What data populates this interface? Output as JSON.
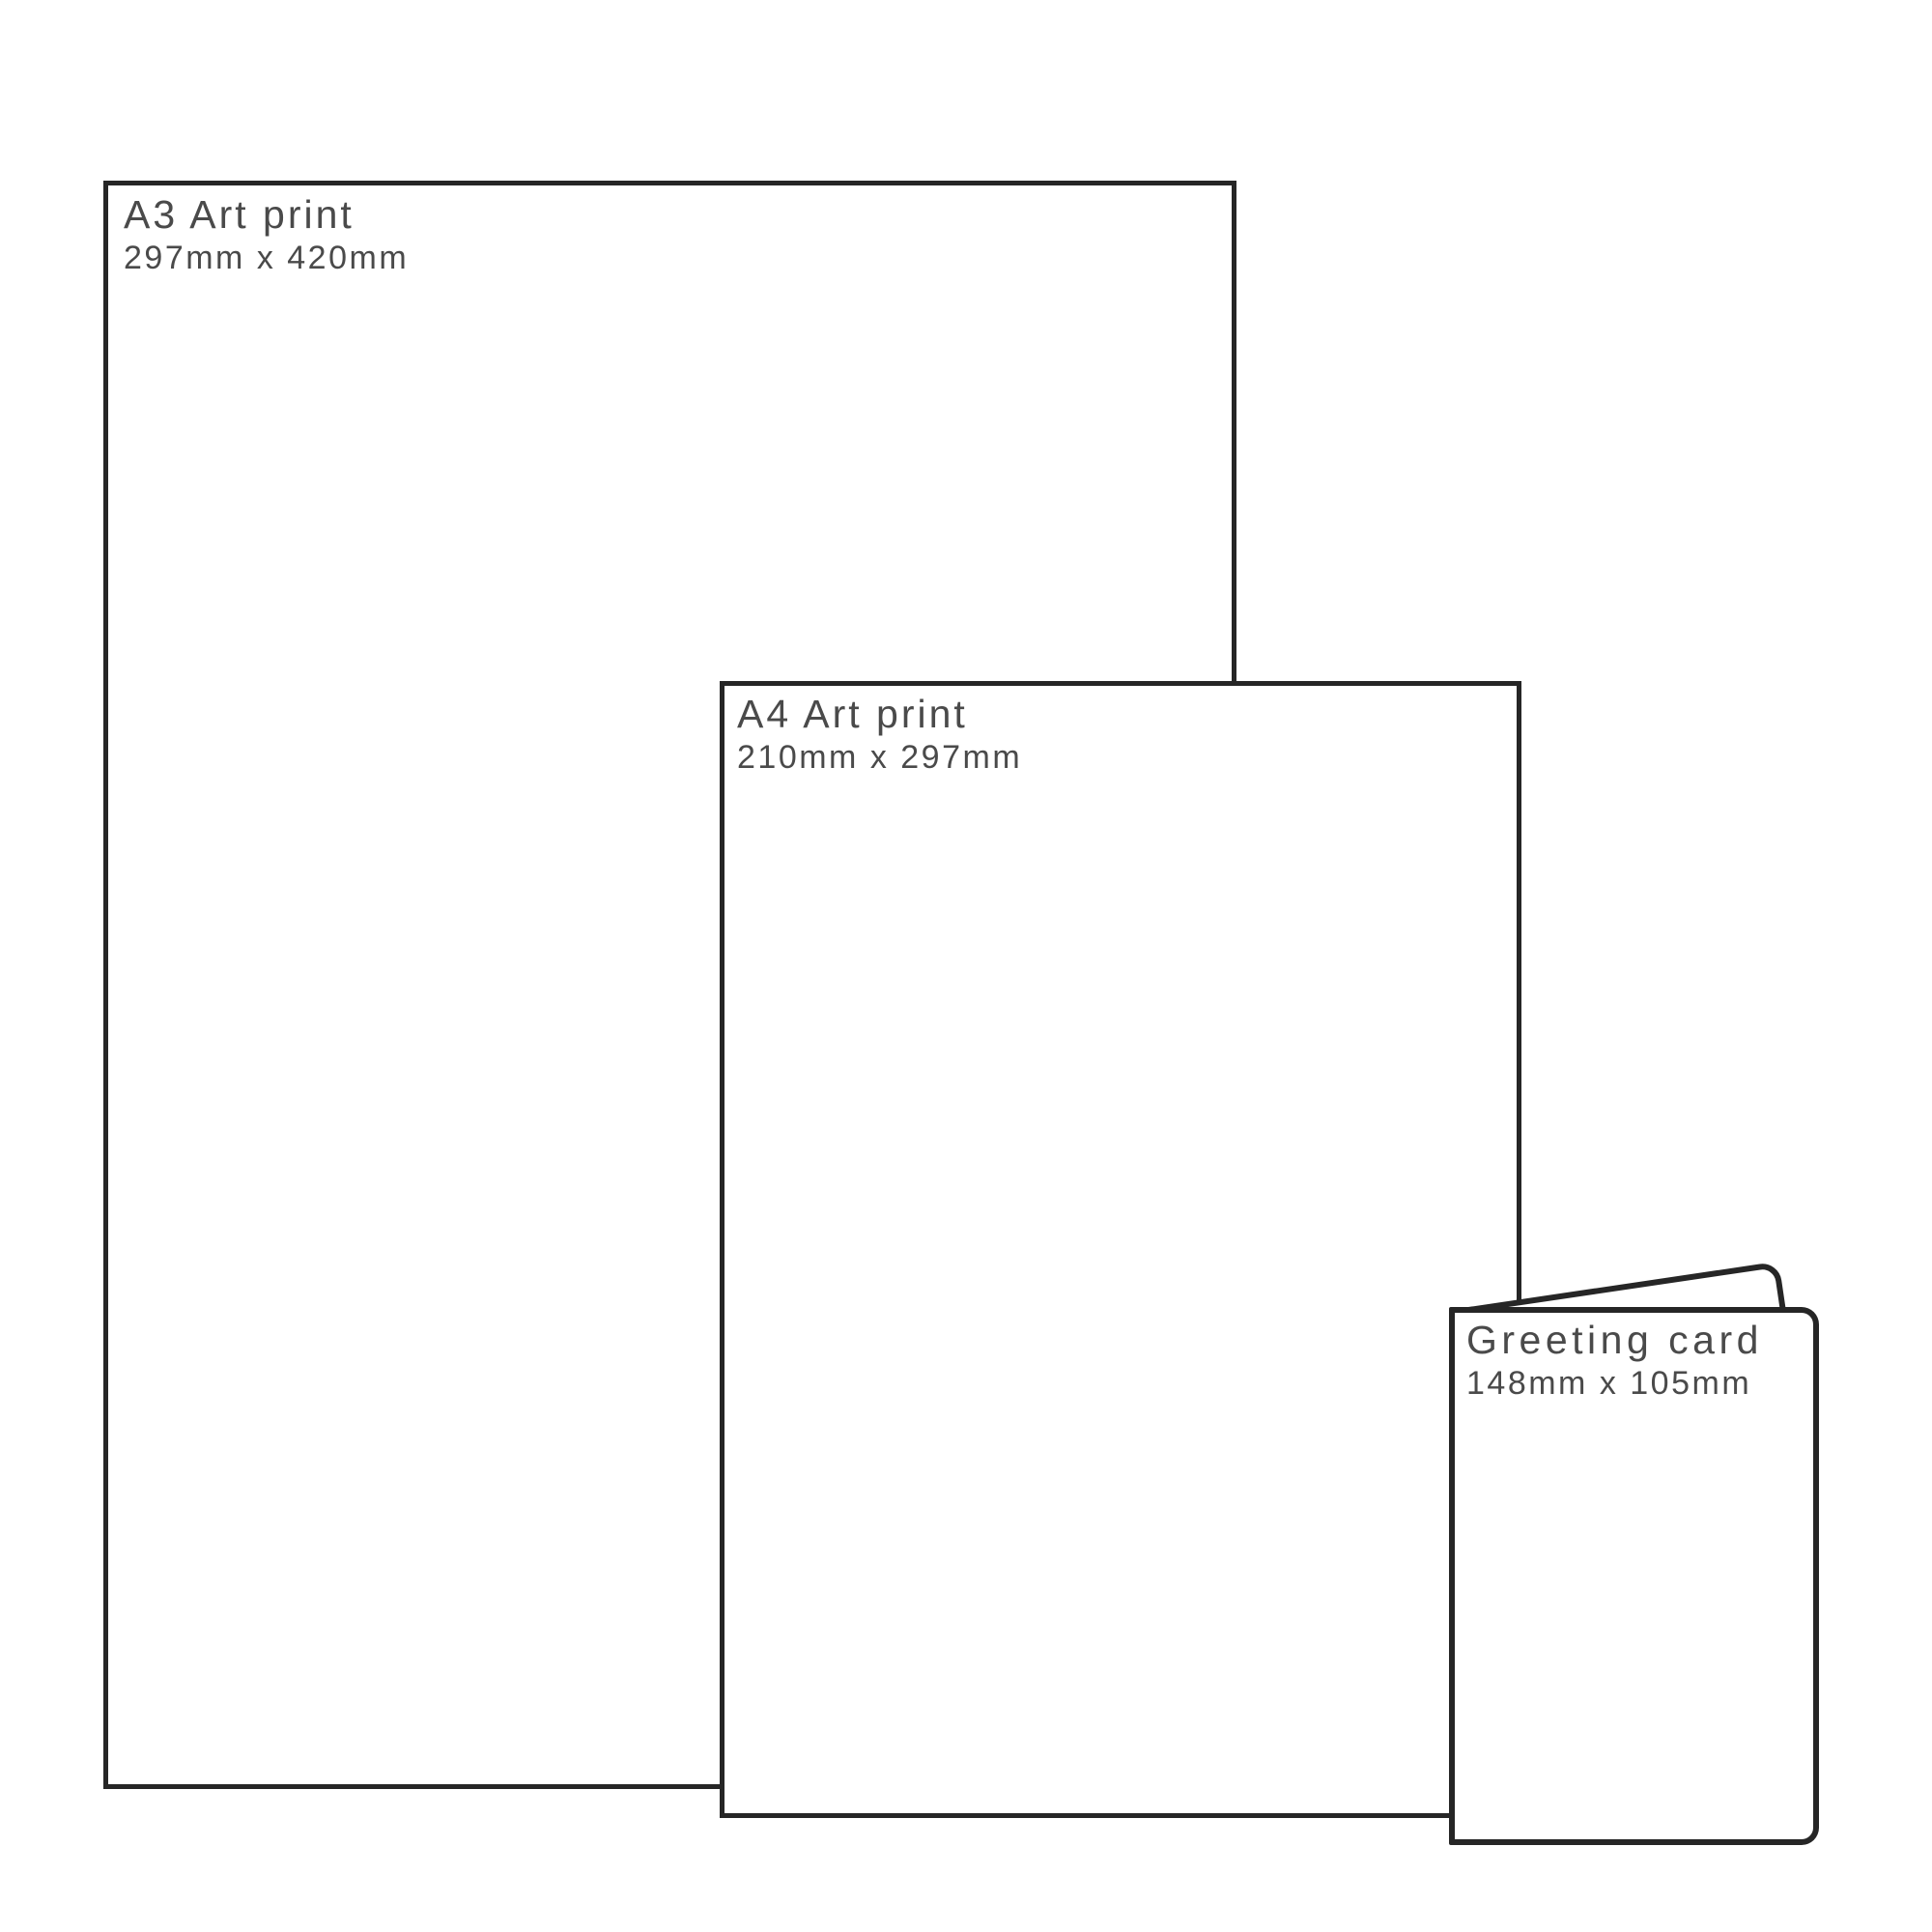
{
  "diagram": {
    "description": "Print size comparison diagram",
    "items": [
      {
        "id": "a3",
        "title": "A3 Art print",
        "dimensions": "297mm x 420mm"
      },
      {
        "id": "a4",
        "title": "A4 Art print",
        "dimensions": "210mm x 297mm"
      },
      {
        "id": "card",
        "title": "Greeting card",
        "dimensions": "148mm x 105mm"
      }
    ]
  },
  "colors": {
    "outline": "#262626",
    "text": "#4a4a4a",
    "background": "#ffffff"
  }
}
